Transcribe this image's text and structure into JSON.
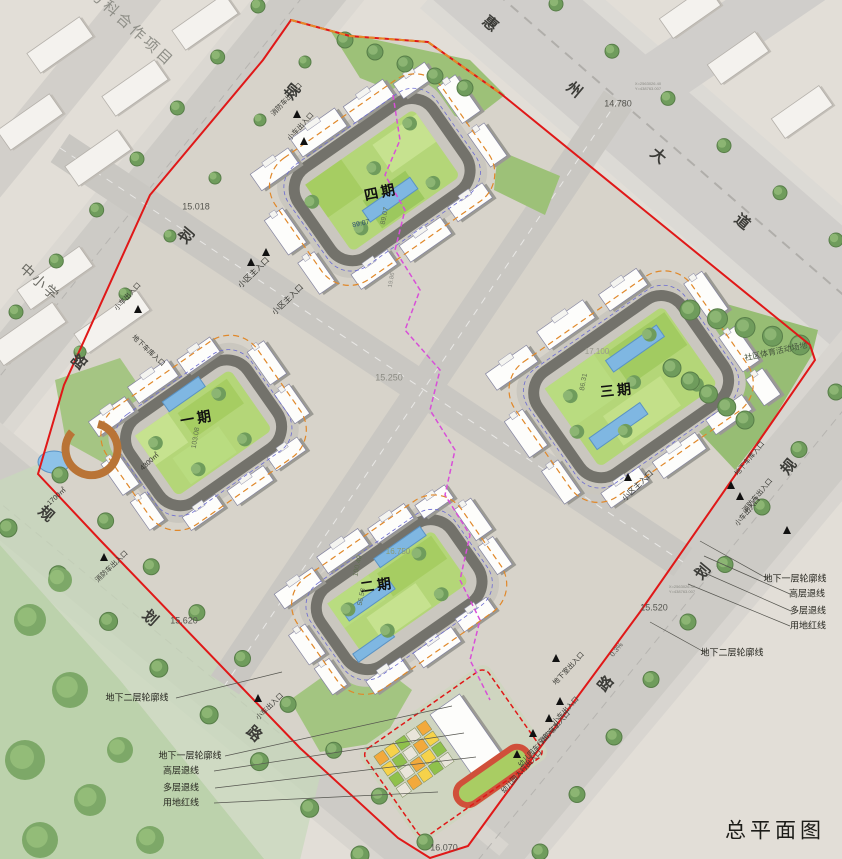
{
  "title": "总平面图",
  "context": {
    "project": "交万科合作项目",
    "school": "中小学",
    "sports": "社区体育活动场地"
  },
  "roads": {
    "huizhou": {
      "name": "惠州大道",
      "chars": [
        "惠",
        "州",
        "大",
        "道"
      ]
    },
    "planned": {
      "name": "规划路",
      "chars": [
        "规",
        "划",
        "路"
      ]
    }
  },
  "phases": {
    "p1": "一期",
    "p2": "二期",
    "p3": "三期",
    "p4": "四期"
  },
  "legend": {
    "u1": "地下一层轮廓线",
    "u2": "地下二层轮廓线",
    "high": "高层退线",
    "multi": "多层退线",
    "red": "用地红线"
  },
  "entrances": {
    "main": "小区主入口",
    "car": "小车出入口",
    "fire": "消防车出入口",
    "garage": "地下车库入口",
    "basement": "地下室出入口",
    "kg_car": "幼儿园车行出入口",
    "kg_ped": "幼儿园人行出入口"
  },
  "elevations": {
    "e1": "15.018",
    "e2": "14.780",
    "e3": "15.250",
    "e4": "15.520",
    "e5": "15.620",
    "e6": "16.070",
    "e7": "17.100",
    "e8": "16.750"
  },
  "lawn_numbers": {
    "p4a": "89.07",
    "p4b": "89.07",
    "p3a": "86.31",
    "p1a": "103.08",
    "p2a": "100.49",
    "p2b": "56.53",
    "road": "19.86"
  },
  "areas": {
    "a1": "4300㎡",
    "a2": "1700㎡"
  },
  "slope": "0.3%",
  "coords": {
    "x": "X=2563026.40",
    "y": "Y=438763.007"
  },
  "colors": {
    "red_line": "#e01818",
    "orange_dash": "#e58a28",
    "magenta_dash": "#d84fd8",
    "blue_dash": "#6b6bd0",
    "lawn": "#b4d678",
    "pool": "#7fb7e2",
    "road": "#cdcbc6",
    "ring_road": "#73726b",
    "park": "#bcd2ac"
  }
}
